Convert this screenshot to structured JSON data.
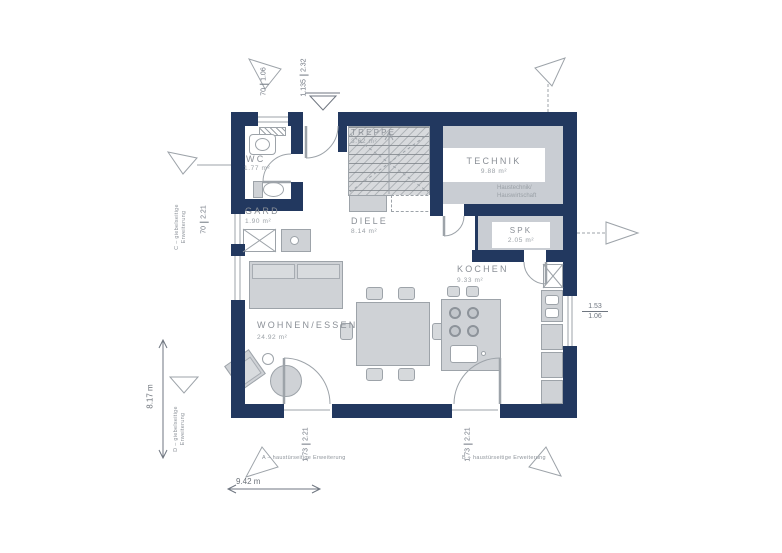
{
  "plan": {
    "rooms": [
      {
        "name": "WC",
        "area": "1.77 m²"
      },
      {
        "name": "GARD",
        "area": "1.90 m²"
      },
      {
        "name": "TREPPE",
        "area": "3.62 m²"
      },
      {
        "name": "DIELE",
        "area": "8.14 m²"
      },
      {
        "name": "TECHNIK",
        "area": "9.88 m²",
        "note1": "Haustechnik/",
        "note2": "Hauswirtschaft"
      },
      {
        "name": "SPK",
        "area": "2.05 m²"
      },
      {
        "name": "KOCHEN",
        "area": "9.33 m²"
      },
      {
        "name": "WOHNEN/ESSEN",
        "area": "24.92 m²"
      }
    ],
    "dimensions": {
      "wc_window": {
        "w": "70",
        "h": "1.06"
      },
      "entry_door": {
        "w": "1.135",
        "h": "2.32"
      },
      "gard_window": {
        "w": "70",
        "h": "2.21"
      },
      "kitchen_window": {
        "w": "1.53",
        "h": "1.06"
      },
      "terrace_door_left": {
        "w": "1.73",
        "h": "2.21"
      },
      "terrace_door_right": {
        "w": "1.73",
        "h": "2.21"
      },
      "overall_width": "9.42 m",
      "overall_depth": "8.17 m"
    },
    "annotations": {
      "bottom_left": "A – haustürseitige Erweiterung",
      "bottom_right": "B – haustürseitige Erweiterung",
      "left_top_line1": "C – giebelseitige",
      "left_top_line2": "Erweiterung",
      "left_bottom_line1": "D – giebelseitige",
      "left_bottom_line2": "Erweiterung"
    },
    "colors": {
      "wall": "#22385f",
      "room_fill": "#c9cdd3",
      "line_gray": "#9da3a9"
    },
    "icons": [
      "sofa",
      "armchair",
      "coffee-table",
      "plant",
      "dining-table",
      "dining-chair",
      "kitchen-island",
      "bar-stool",
      "cooktop",
      "island-sink",
      "kitchen-sink",
      "shaft",
      "wardrobe",
      "bench",
      "washbasin",
      "toilet",
      "radiator",
      "stairs",
      "extension-arrow",
      "entrance-marker",
      "door-swing",
      "window"
    ]
  }
}
